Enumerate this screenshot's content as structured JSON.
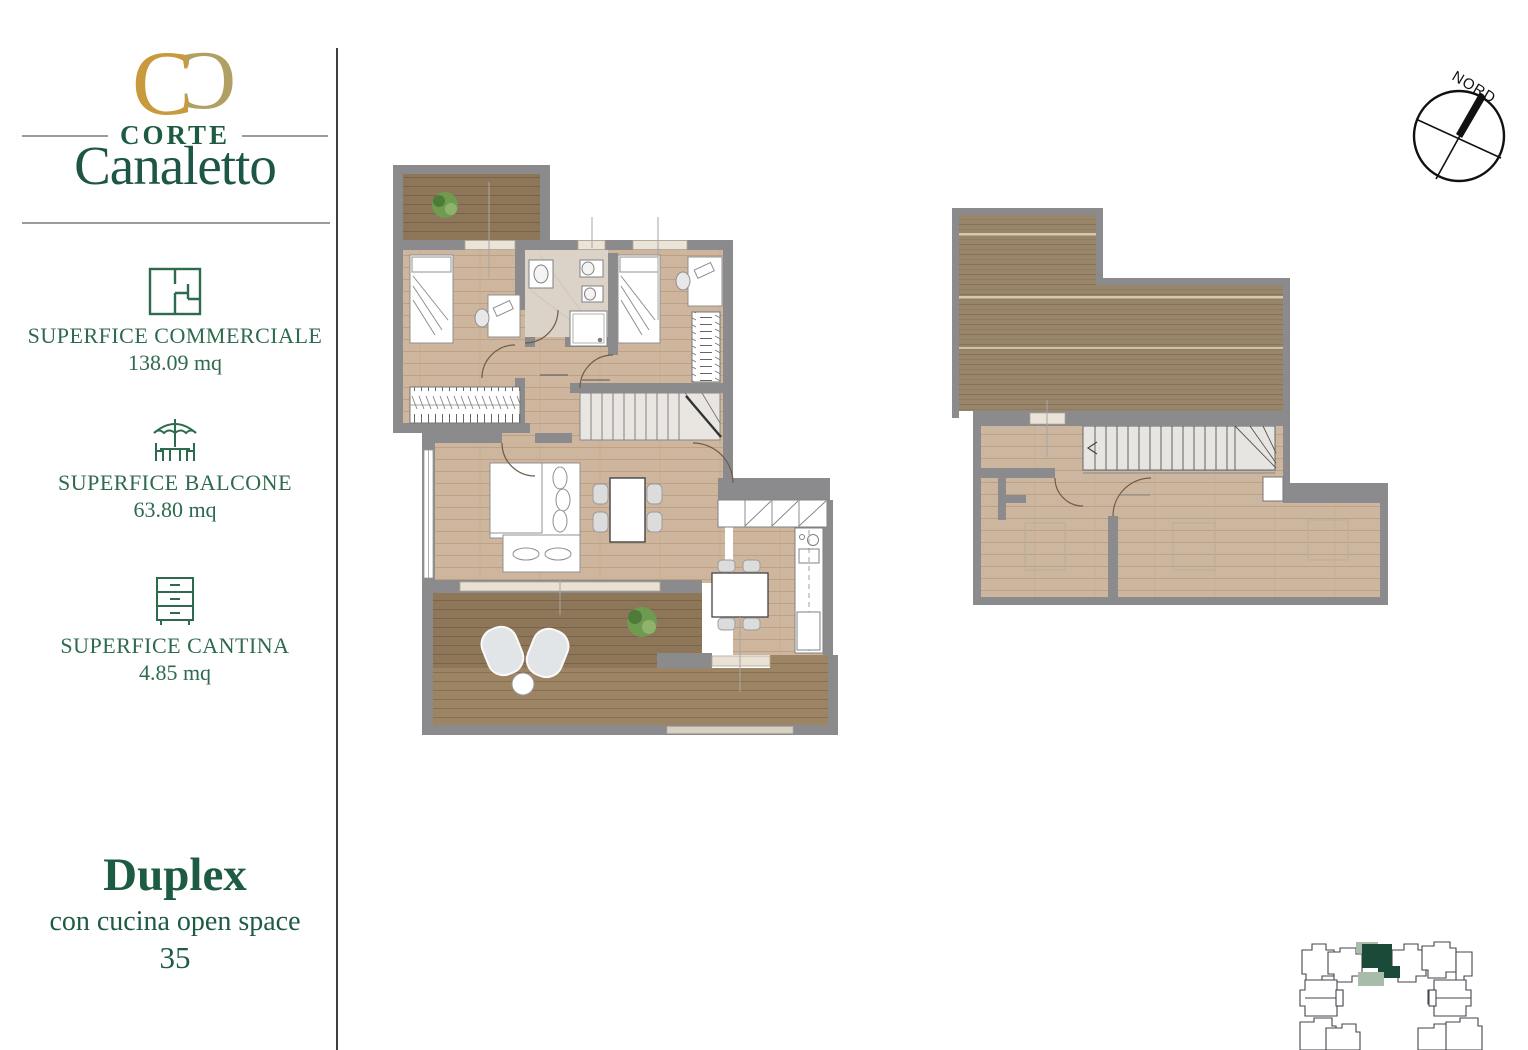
{
  "brand": {
    "kicker": "CORTE",
    "name": "Canaletto"
  },
  "stats": [
    {
      "icon": "floorplan-icon",
      "label": "SUPERFICE COMMERCIALE",
      "value": "138.09 mq"
    },
    {
      "icon": "balcony-umbrella-icon",
      "label": "SUPERFICE BALCONE",
      "value": "63.80 mq"
    },
    {
      "icon": "cellar-drawers-icon",
      "label": "SUPERFICE CANTINA",
      "value": "4.85 mq"
    }
  ],
  "unit": {
    "type": "Duplex",
    "subtitle": "con cucina open space",
    "number": "35"
  },
  "compass": {
    "label": "NORD"
  },
  "colors": {
    "brand_green": "#1d5c42",
    "logo_gold": "#c89a3d",
    "logo_tan": "#b0a063",
    "wall_gray": "#8b8b8e",
    "floor_wood": "#cdb69d",
    "deck_brown": "#8e7758",
    "highlight_dark_green": "#1c4a38",
    "highlight_sage": "#a8bda9"
  }
}
